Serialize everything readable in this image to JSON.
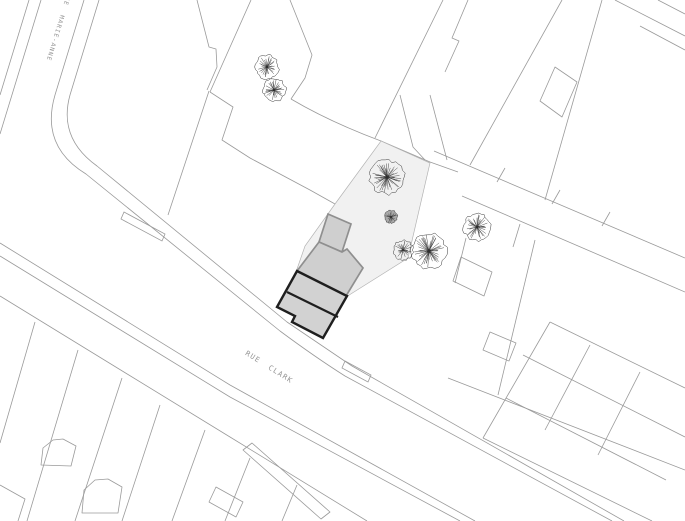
{
  "drawing": {
    "kind": "site plan"
  },
  "streets": [
    {
      "name": "RUE MARIE-ANNE"
    },
    {
      "name": "RUE CLARK"
    }
  ],
  "colors": {
    "background": "#ffffff",
    "parcel_line": "#9a9a9a",
    "lot_fill": "#f1f1f1",
    "lot_line": "#b3b3b3",
    "building_fill": "#cfcfcf",
    "building_line": "#8f8f8f",
    "proposed_fill": "#d2d2d2",
    "proposed_outline": "#1f1f1f",
    "tree_line": "#3a3a3a",
    "label": "#949494"
  },
  "trees": [
    {
      "x": 267,
      "y": 67,
      "r": 12,
      "style": "outline"
    },
    {
      "x": 274,
      "y": 90,
      "r": 11.5,
      "style": "outline"
    },
    {
      "x": 387,
      "y": 177,
      "r": 17,
      "style": "outline"
    },
    {
      "x": 391,
      "y": 217,
      "r": 6.5,
      "style": "dense"
    },
    {
      "x": 403,
      "y": 250,
      "r": 10,
      "style": "outline"
    },
    {
      "x": 429,
      "y": 251,
      "r": 17.5,
      "style": "outline"
    },
    {
      "x": 477,
      "y": 227,
      "r": 13.5,
      "style": "outline"
    }
  ]
}
